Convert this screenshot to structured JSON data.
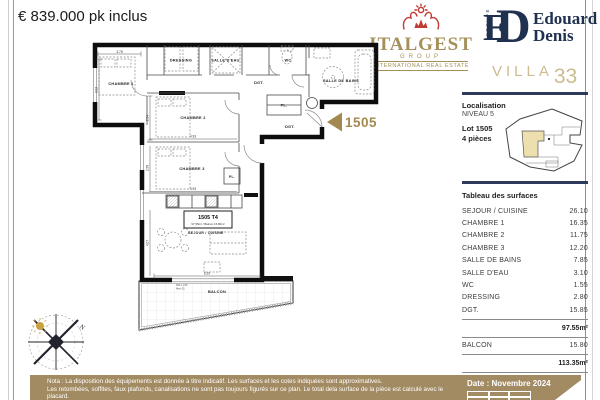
{
  "price": "€ 839.000 pk inclus",
  "logos": {
    "italgest": {
      "name": "ITALGEST",
      "group": "GROUP",
      "tagline": "INTERNATIONAL REAL ESTATE"
    },
    "edouard": {
      "monogram_e": "E",
      "monogram_d": "D",
      "groupe": "GROUPE",
      "line1": "Edouard",
      "line2": "Denis"
    },
    "villa": {
      "word": "VILLA",
      "number": "33"
    }
  },
  "sidebar": {
    "localisation": {
      "title": "Localisation",
      "level": "NIVEAU 5",
      "lot": "Lot 1505",
      "type": "4 pièces"
    },
    "surfaces": {
      "title": "Tableau des surfaces",
      "rows": [
        {
          "label": "SEJOUR / CUISINE",
          "value": "26.10"
        },
        {
          "label": "CHAMBRE 1",
          "value": "16.35"
        },
        {
          "label": "CHAMBRE 2",
          "value": "11.75"
        },
        {
          "label": "CHAMBRE 3",
          "value": "12.20"
        },
        {
          "label": "SALLE DE BAINS",
          "value": "7.85"
        },
        {
          "label": "SALLE D'EAU",
          "value": "3.10"
        },
        {
          "label": "WC",
          "value": "1.55"
        },
        {
          "label": "DRESSING",
          "value": "2.80"
        },
        {
          "label": "DGT.",
          "value": "15.85"
        }
      ],
      "subtotal": "97.55m²",
      "balcon": {
        "label": "BALCON",
        "value": "15.80"
      },
      "total": "113.35m²"
    }
  },
  "plan": {
    "arrow_lot": "1505",
    "labels": {
      "chambre1": "CHAMBRE 1",
      "chambre2": "CHAMBRE 2",
      "chambre3": "CHAMBRE 3",
      "dressing": "DRESSING",
      "salle_eau": "SALLE D'EAU",
      "wc": "WC",
      "salle_bains": "SALLE DE BAINS",
      "dgt": "DGT.",
      "pl": "PL.",
      "sejour": "SEJOUR / CUISINE",
      "balcon": "BALCON"
    },
    "unit_box": {
      "title": "1505 T4",
      "subtitle": "97,55m² / Balcon 15,80m²"
    },
    "dims": {
      "c1w": "3.78",
      "c1h": "3.02",
      "c2w": "4.93",
      "c2h": "2.54",
      "c3w": "4.93",
      "c3h": "2.58",
      "sw": "6.20",
      "sh": "4.07"
    },
    "window_note": {
      "size": "900 x 215",
      "ref": "Men 01"
    }
  },
  "compass": {
    "north": "N"
  },
  "footer": {
    "date": "Date : Novembre 2024",
    "notes": [
      "Nota : La disposition des équipements est donnée à titre indicatif. Les surfaces et les cotes indiquées sont approximatives.",
      "Les retombées, soffites, faux plafonds, canalisations ne sont pas toujours figurés sur ce plan. Le total dela surface de la pièce est calculé avec le placard.",
      "La société se réserve la possibilité d'apporter à ce plan les modifications dues à des impératifs d'ordre technique ou administratif."
    ]
  },
  "colors": {
    "gold": "#a6905a",
    "red": "#c23a34",
    "navy": "#20304f",
    "villa_gold": "#cdbb90",
    "tan_band": "#a28a62",
    "arrow_tan": "#a3894f",
    "map_highlight": "#eedfae"
  }
}
